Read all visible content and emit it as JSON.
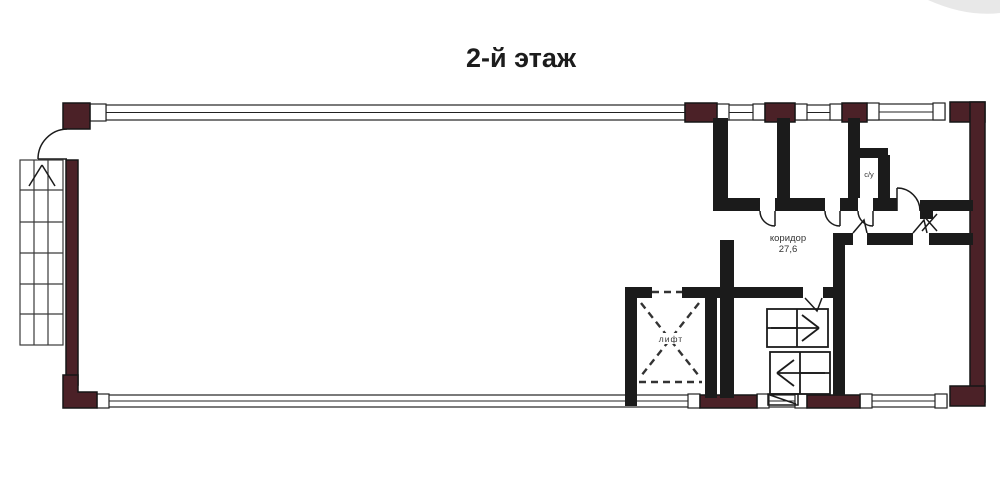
{
  "title": "2-й этаж",
  "plan": {
    "corridor_label": "коридор",
    "corridor_area": "27,6",
    "elevator_label": "лифт",
    "wc_label": "с/у"
  },
  "colors": {
    "background": "#ffffff",
    "brick_wall": "#4b2127",
    "interior_wall": "#1b1b1b",
    "drawing_line": "#2b2b2b",
    "text": "#1c1c1c",
    "watermark": "#e8e8e8"
  }
}
